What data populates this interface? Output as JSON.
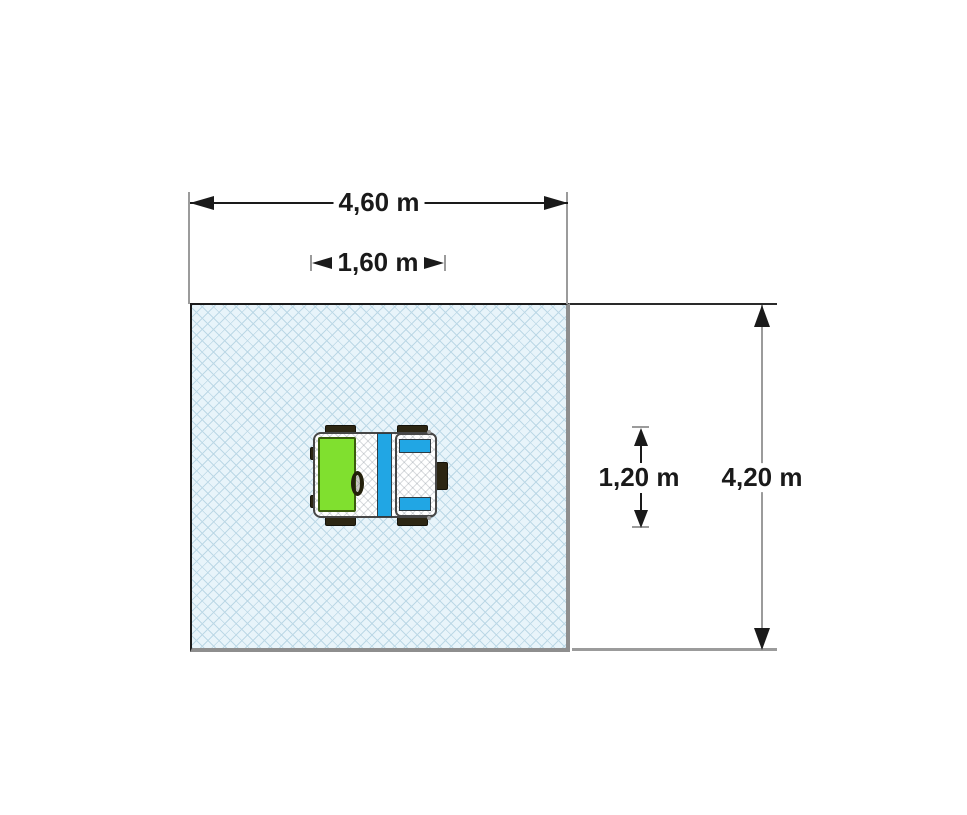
{
  "dimensions": {
    "area_width": {
      "label": "4,60 m",
      "value": 4.6,
      "unit": "m"
    },
    "equipment_width": {
      "label": "1,60 m",
      "value": 1.6,
      "unit": "m"
    },
    "equipment_depth": {
      "label": "1,20 m",
      "value": 1.2,
      "unit": "m"
    },
    "area_depth": {
      "label": "4,20 m",
      "value": 4.2,
      "unit": "m"
    }
  },
  "colors": {
    "dim_text": "#1a1a1a",
    "dim_line": "#1a1a1a",
    "ext_line": "#9b9b9b",
    "area_fill": "#e8f4fa",
    "area_hatch": "#bcd8e6",
    "area_border_dark": "#1b1b1b",
    "area_border_shadow": "#8e8e8e",
    "equipment_green": "#80e02f",
    "equipment_blue": "#21a6e4",
    "equipment_wheel": "#2c2613",
    "equipment_outline": "#474747"
  }
}
